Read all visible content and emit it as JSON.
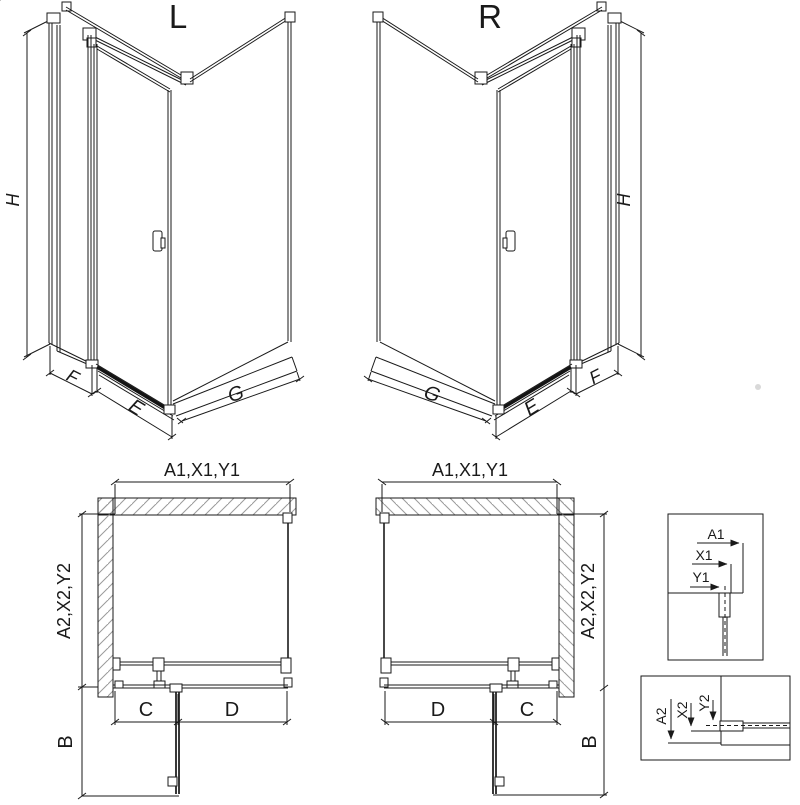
{
  "background": "#ffffff",
  "palette": {
    "line": "#1a1a1a",
    "hatch": "#9a9a9a",
    "dark_bar": "#141414",
    "watermark_dot": "#d9d9d9"
  },
  "perspective_left": {
    "variant": "L",
    "dims": {
      "height": "H",
      "side_panel": "F",
      "door": "E",
      "return_panel": "G"
    }
  },
  "perspective_right": {
    "variant": "R",
    "dims": {
      "height": "H",
      "side_panel": "F",
      "door": "E",
      "return_panel": "G"
    }
  },
  "plan_left": {
    "dims": {
      "width": "A1,X1,Y1",
      "depth": "A2,X2,Y2",
      "door_segment": "C",
      "fixed_segment": "D",
      "door_swing": "B"
    }
  },
  "plan_right": {
    "dims": {
      "width": "A1,X1,Y1",
      "depth": "A2,X2,Y2",
      "door_segment": "C",
      "fixed_segment": "D",
      "door_swing": "B"
    }
  },
  "detail_width_profile": {
    "dims": {
      "outer": "A1",
      "mid": "X1",
      "inner": "Y1"
    }
  },
  "detail_depth_profile": {
    "dims": {
      "outer": "A2",
      "mid": "X2",
      "inner": "Y2"
    }
  }
}
